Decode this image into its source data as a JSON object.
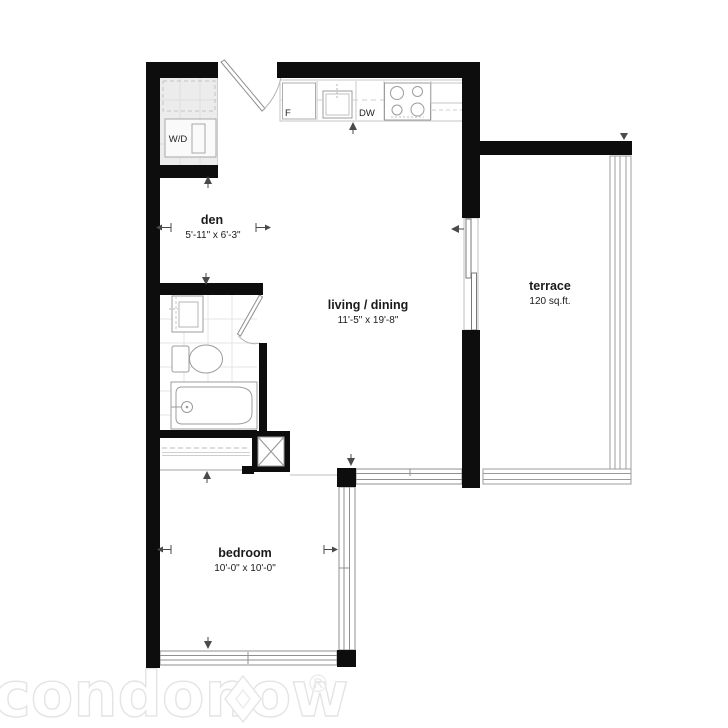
{
  "rooms": {
    "den": {
      "name": "den",
      "dims": "5'-11\" x 6'-3\""
    },
    "living": {
      "name": "living / dining",
      "dims": "11'-5\" x 19'-8\""
    },
    "terrace": {
      "name": "terrace",
      "dims": "120 sq.ft."
    },
    "bedroom": {
      "name": "bedroom",
      "dims": "10'-0\" x 10'-0\""
    }
  },
  "appliances": {
    "washer_dryer": "W/D",
    "fridge": "F",
    "dishwasher": "DW"
  },
  "watermark": {
    "brand": "condonow",
    "registered": "®"
  },
  "colors": {
    "background": "#ffffff",
    "wall": "#0d0d0d",
    "fixture_line": "#9c9c9c",
    "light_line": "#c9c9c9",
    "tile_line": "#e4e4e4",
    "label_text": "#1a1a1a",
    "marker": "#4a4a4a",
    "watermark": "#e4e4e4"
  }
}
